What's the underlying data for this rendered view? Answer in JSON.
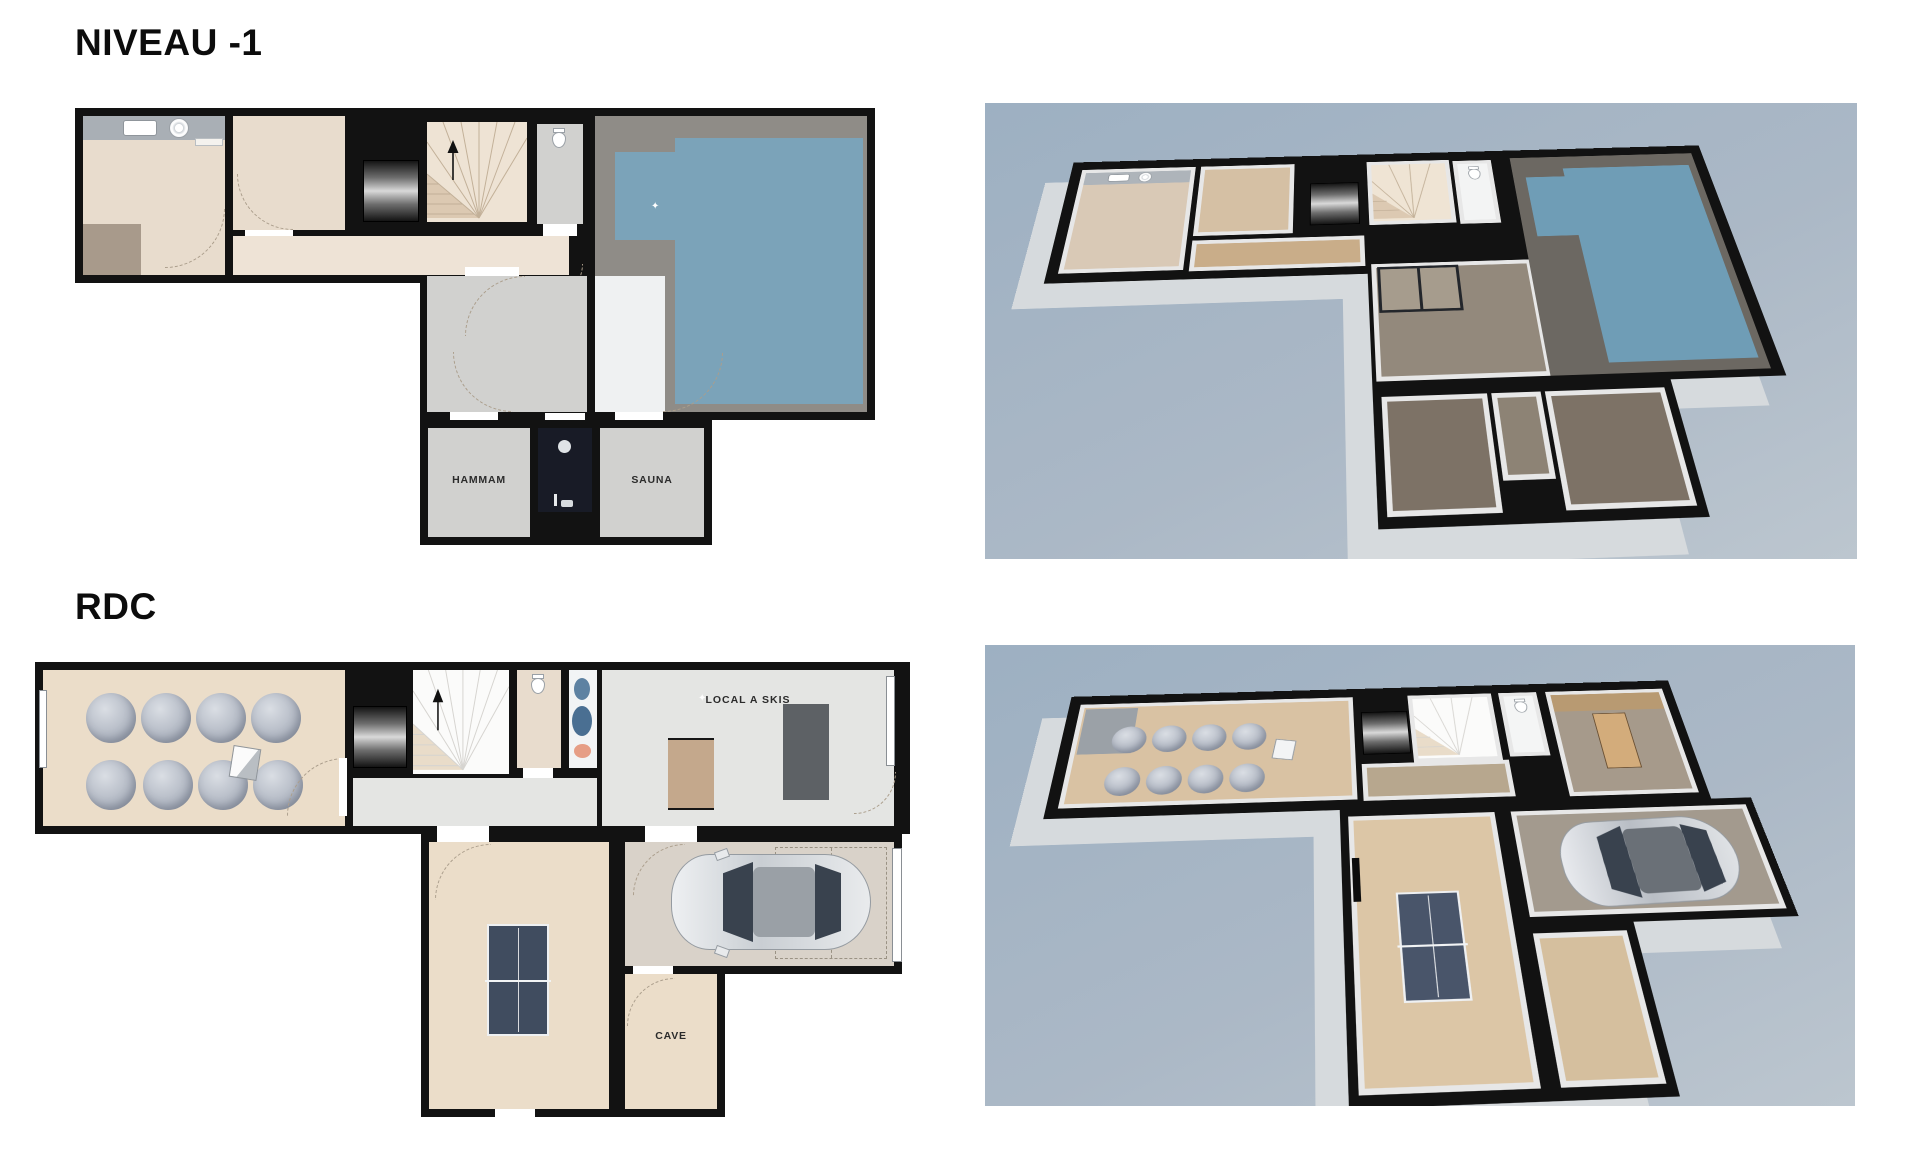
{
  "page": {
    "background": "#ffffff"
  },
  "niveau1": {
    "title": "NIVEAU -1",
    "rooms": {
      "hammam": "HAMMAM",
      "sauna": "SAUNA"
    }
  },
  "rdc": {
    "title": "RDC",
    "rooms": {
      "local_skis": "LOCAL A SKIS",
      "cave": "CAVE"
    }
  },
  "icons": {
    "sparkle": "✦"
  },
  "colors": {
    "paper": "#ffffff",
    "wall": "#121212",
    "beige": "#e8dccd",
    "beige2": "#eee3d6",
    "greytile": "#d1d1cf",
    "whitetile": "#eff1f2",
    "stone": "#8f8c87",
    "water": "#7ba3b9",
    "dark_shower": "#181b26",
    "wood": "#ebddc9",
    "ltgrey": "#e4e5e3",
    "garage_floor": "#d9d2c9",
    "iso_bg_top": "#9db0c2",
    "iso_bg_bottom": "#bcc6cf",
    "iso_skirt": "#d6dadd",
    "pouf": "#b5bbc6",
    "pingpong": "#404c5f",
    "car_body": "#dde0e3",
    "label": "#2b2b2b",
    "counter": "#a9afb5",
    "mat": "#a89a8b",
    "door_wood": "#c4a88c",
    "doormat_dark": "#5d6165"
  }
}
